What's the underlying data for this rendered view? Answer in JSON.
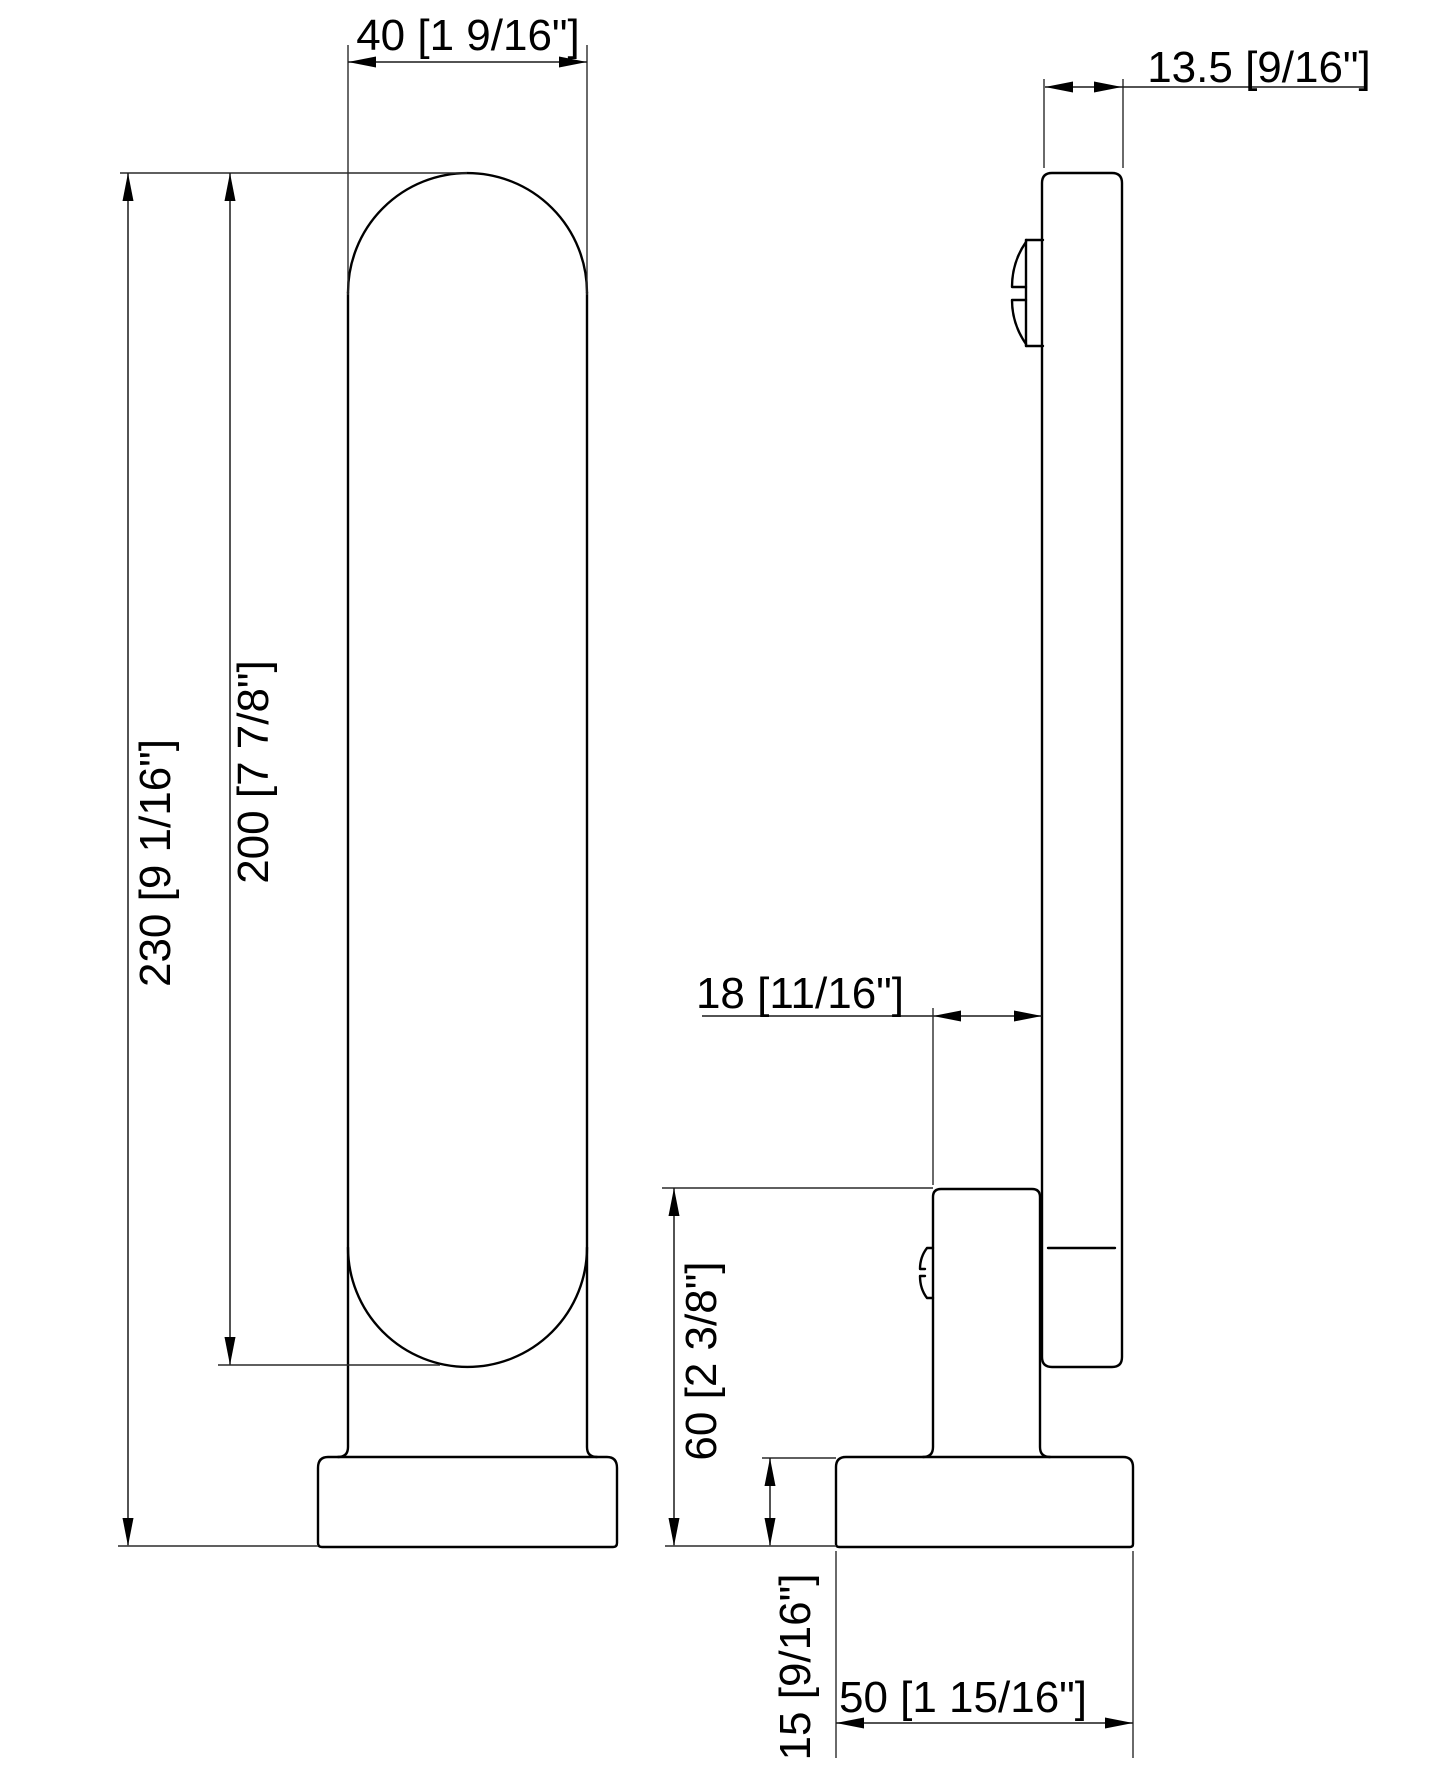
{
  "drawing": {
    "dimensions": {
      "body_width": "40 [1 9/16\"]",
      "plate_thickness": "13.5 [9/16\"]",
      "overall_height": "230 [9 1/16\"]",
      "body_height": "200 [7 7/8\"]",
      "bracket_depth": "18 [11/16\"]",
      "mount_height": "60 [2 3/8\"]",
      "base_height": "15 [9/16\"]",
      "base_width": "50 [1 15/16\"]"
    },
    "colors": {
      "line": "#000000",
      "background": "#ffffff"
    }
  }
}
